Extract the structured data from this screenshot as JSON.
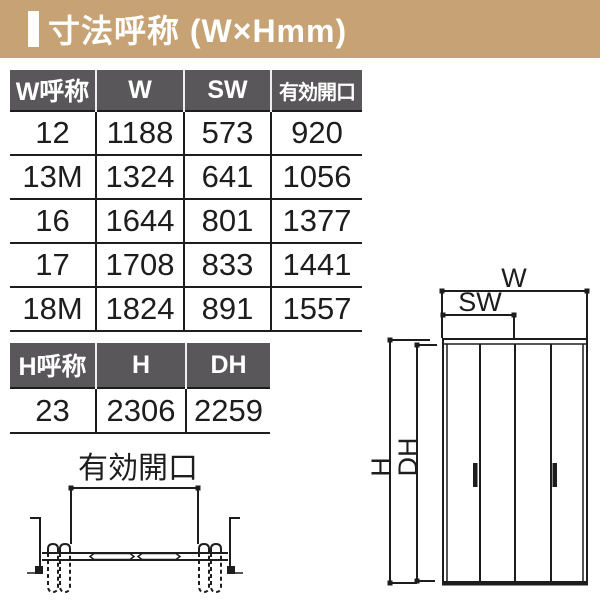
{
  "title": {
    "text": "寸法呼称 (W×Hmm)"
  },
  "colors": {
    "band": "#c6a274",
    "table_header_bg": "#595759",
    "line": "#1d1d1d"
  },
  "tables": {
    "width": {
      "headers": [
        "W呼称",
        "W",
        "SW",
        "有効開口"
      ],
      "rows": [
        [
          "12",
          "1188",
          "573",
          "920"
        ],
        [
          "13M",
          "1324",
          "641",
          "1056"
        ],
        [
          "16",
          "1644",
          "801",
          "1377"
        ],
        [
          "17",
          "1708",
          "833",
          "1441"
        ],
        [
          "18M",
          "1824",
          "891",
          "1557"
        ]
      ]
    },
    "height": {
      "headers": [
        "H呼称",
        "H",
        "DH"
      ],
      "rows": [
        [
          "23",
          "2306",
          "2259"
        ]
      ]
    }
  },
  "diagrams": {
    "opening_section": {
      "label": "有効開口"
    },
    "door_elevation": {
      "width_label": "W",
      "slide_width_label": "SW",
      "height_label": "H",
      "door_height_label": "DH"
    }
  }
}
